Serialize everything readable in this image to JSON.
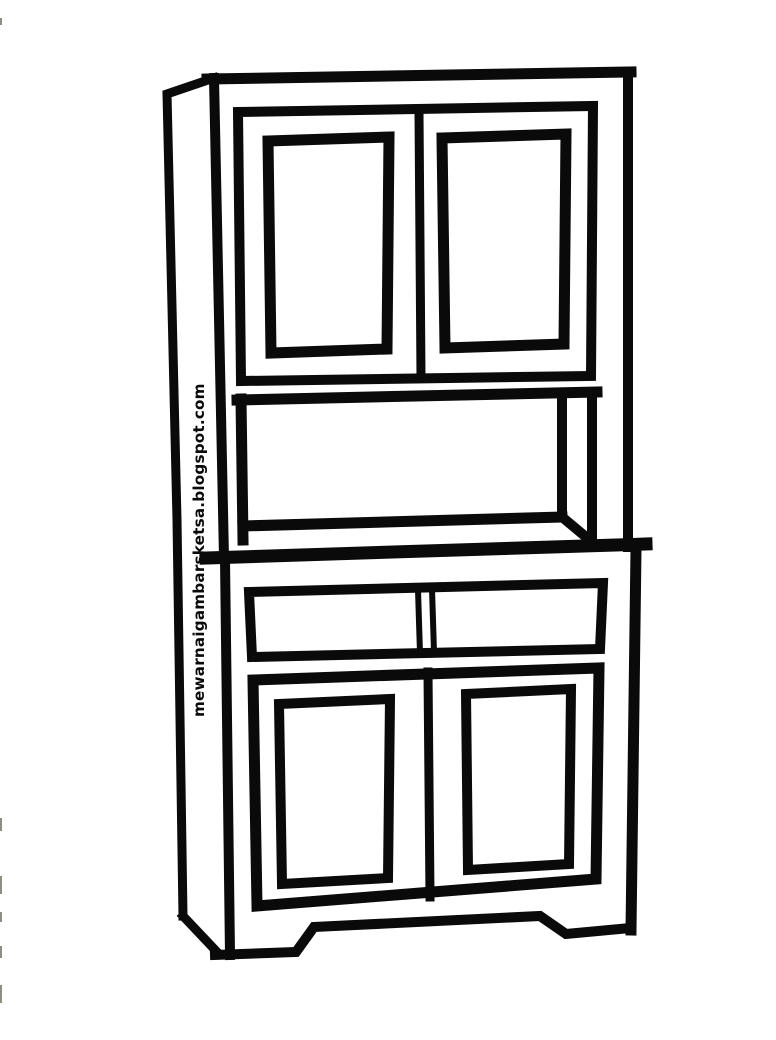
{
  "watermark": {
    "text": "mewarnaigambarsketsa.blogspot.com"
  },
  "art": {
    "subject": "cupboard-hutch-cabinet-coloring-sketch",
    "line_color": "#0a0a0a",
    "background_color": "#ffffff",
    "artifact_color": "#8e8e82"
  }
}
